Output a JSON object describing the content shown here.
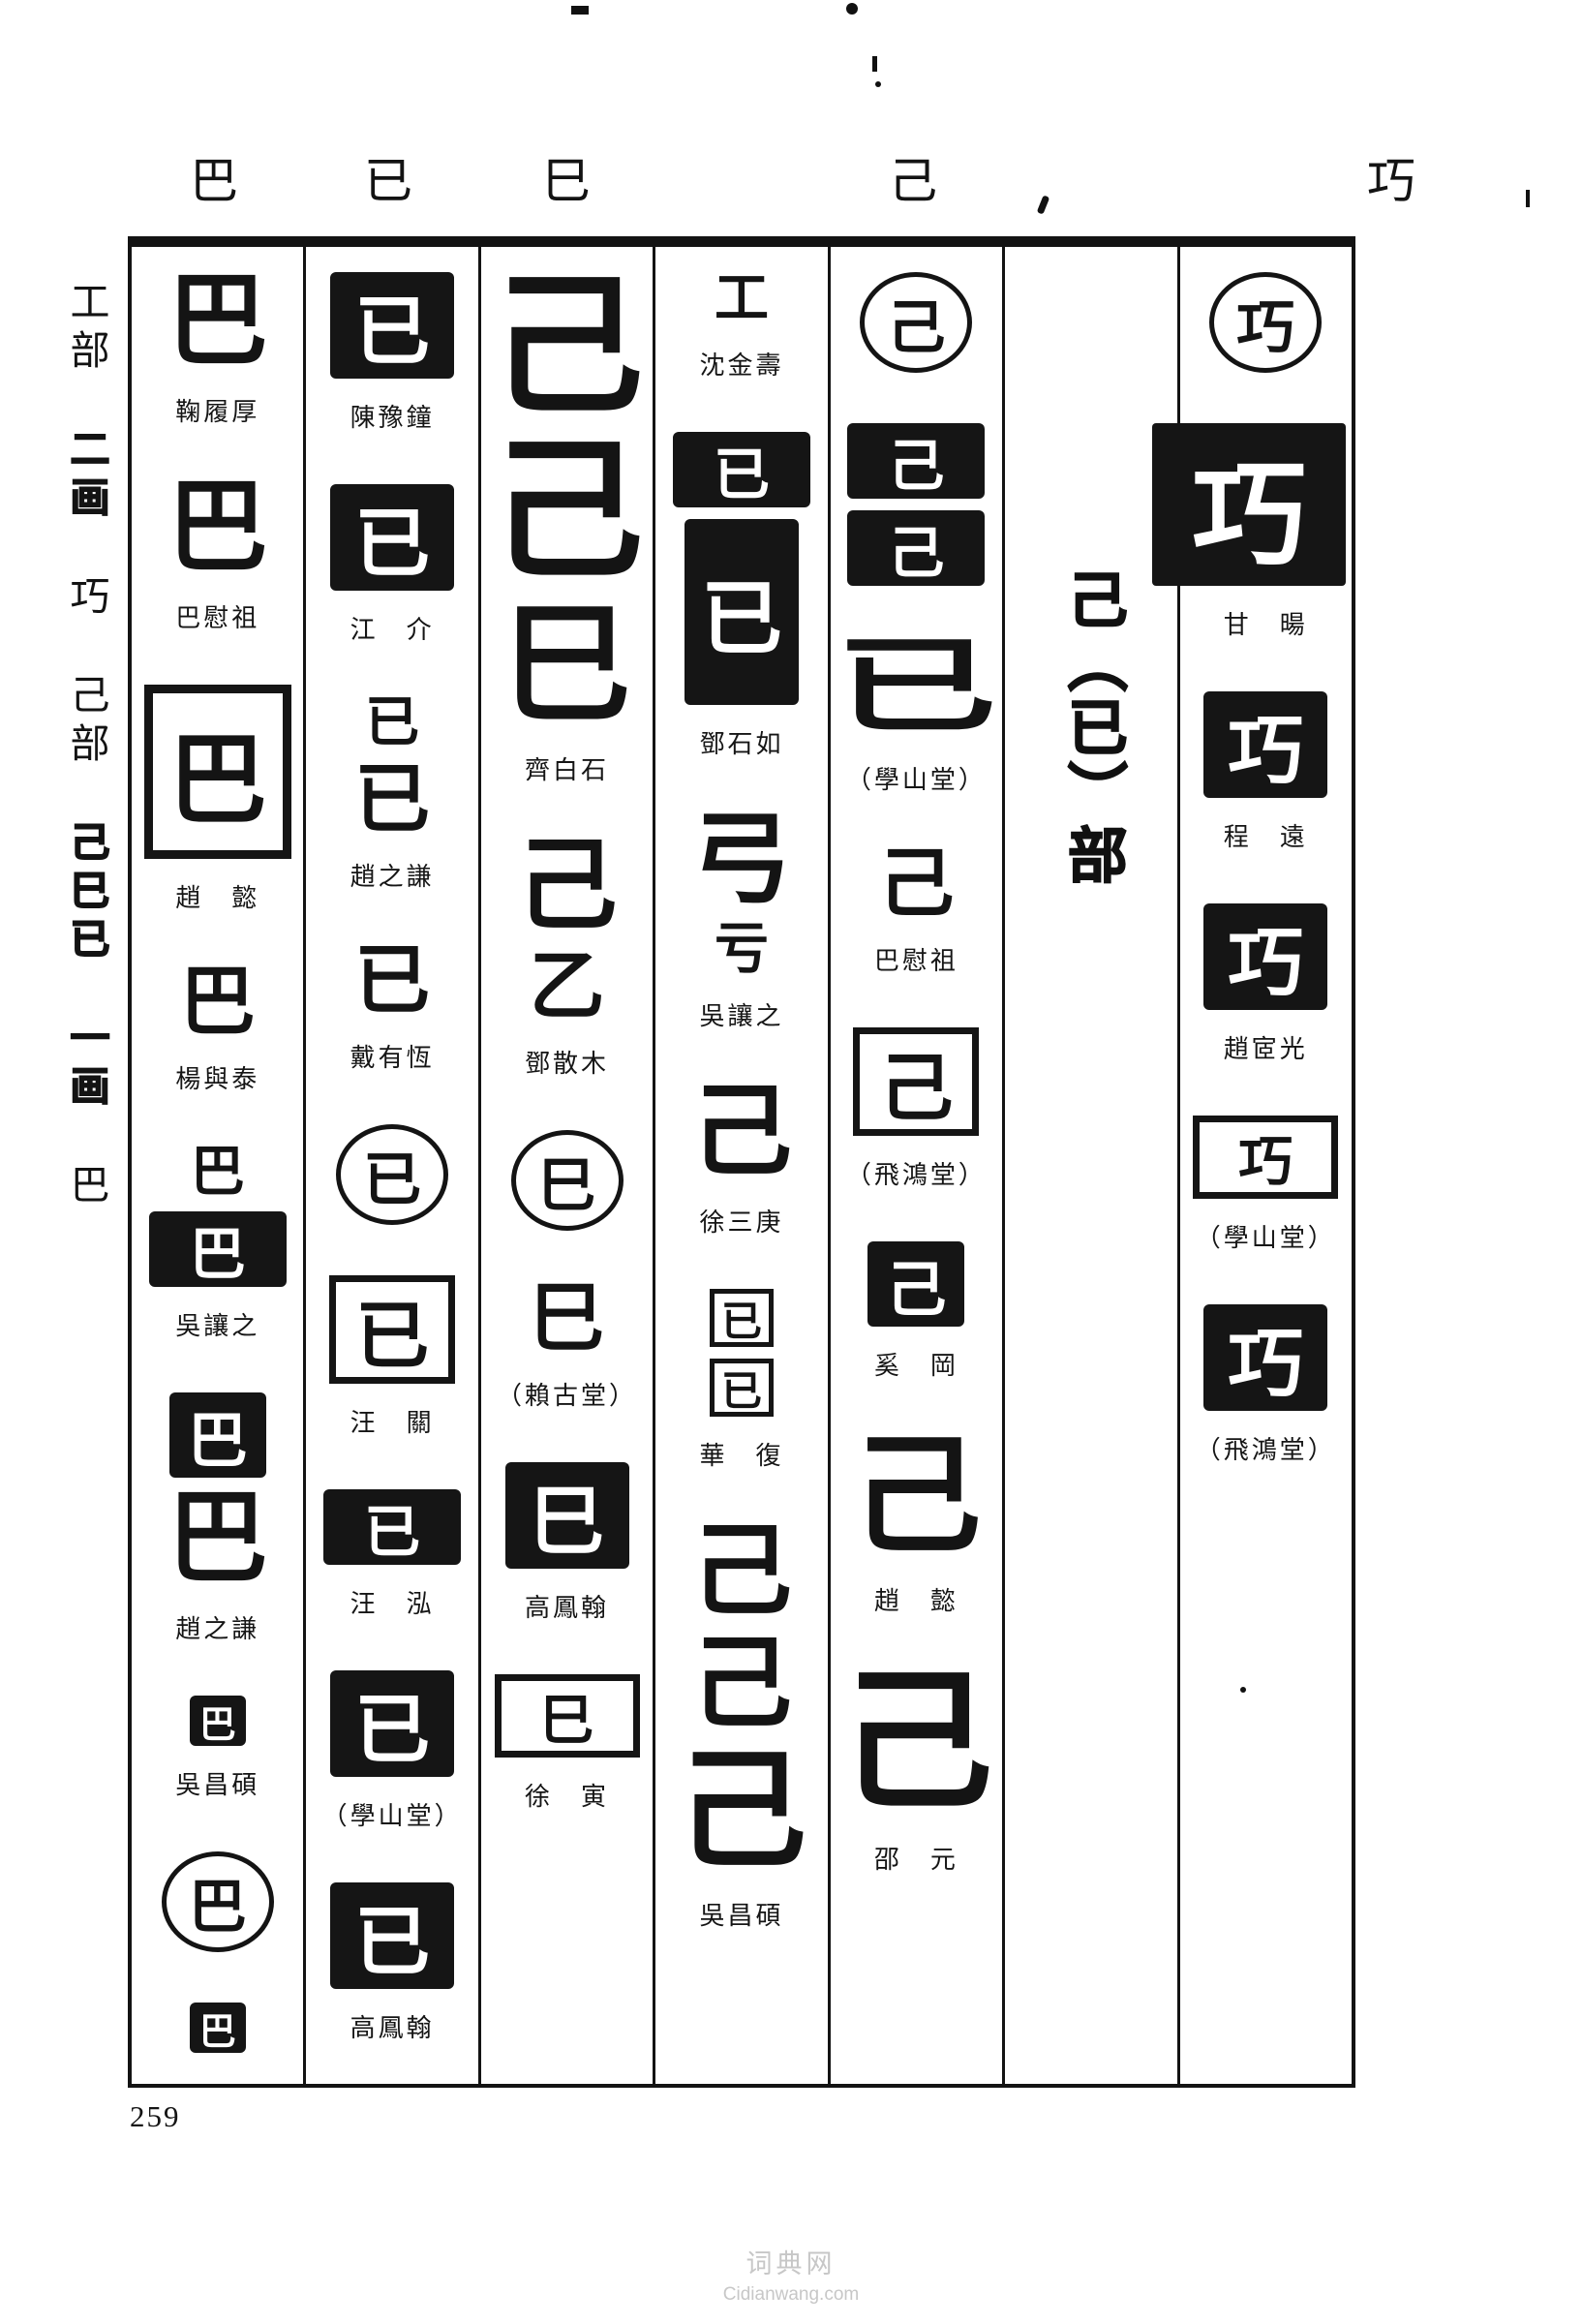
{
  "page": {
    "number": "259",
    "watermark_name": "词典网",
    "watermark_url": "Cidianwang.com",
    "ink_color": "#131313",
    "paper_color": "#ffffff",
    "watermark_color": "#c7c7c7"
  },
  "header": {
    "chars": [
      "巴",
      "已",
      "巳",
      "己",
      "巧"
    ]
  },
  "sidebar": {
    "items": [
      {
        "text": "工部",
        "bold": false
      },
      {
        "text": "二画",
        "bold": true
      },
      {
        "text": "巧",
        "bold": false
      },
      {
        "text": "己部",
        "bold": false
      },
      {
        "text": "己巳已",
        "bold": true
      },
      {
        "text": "一画",
        "bold": true
      },
      {
        "text": "巴",
        "bold": false
      }
    ]
  },
  "section_title": {
    "text": "己（已）部"
  },
  "columns": [
    {
      "head": "巴",
      "entries": [
        {
          "seals": [
            {
              "type": "brush",
              "ch": "巴",
              "size": "md"
            }
          ],
          "name": "鞠履厚"
        },
        {
          "seals": [
            {
              "type": "brush",
              "ch": "巴",
              "size": "md"
            }
          ],
          "name": "巴慰祖"
        },
        {
          "seals": [
            {
              "type": "outline",
              "ch": "巴",
              "size": "lg"
            }
          ],
          "name": "趙　懿"
        },
        {
          "seals": [
            {
              "type": "brush",
              "ch": "巴",
              "size": "sm"
            }
          ],
          "name": "楊與泰"
        },
        {
          "seals": [
            {
              "type": "brush",
              "ch": "巴",
              "size": "xs"
            },
            {
              "type": "black",
              "ch": "巴",
              "size": "bar"
            }
          ],
          "name": "吳讓之"
        },
        {
          "seals": [
            {
              "type": "black",
              "ch": "巴",
              "size": "sm"
            },
            {
              "type": "brush",
              "ch": "巴",
              "size": "md"
            }
          ],
          "name": "趙之謙"
        },
        {
          "seals": [
            {
              "type": "black",
              "ch": "巴",
              "size": "xs"
            }
          ],
          "name": "吳昌碩"
        },
        {
          "seals": [
            {
              "type": "circle",
              "ch": "巴",
              "size": "md"
            }
          ],
          "name": ""
        },
        {
          "seals": [
            {
              "type": "black",
              "ch": "巴",
              "size": "xs"
            }
          ],
          "name": ""
        }
      ]
    },
    {
      "head": "已",
      "entries": [
        {
          "seals": [
            {
              "type": "black",
              "ch": "已",
              "size": "md"
            }
          ],
          "name": "陳豫鐘"
        },
        {
          "seals": [
            {
              "type": "black",
              "ch": "已",
              "size": "md"
            }
          ],
          "name": "江　介"
        },
        {
          "seals": [
            {
              "type": "brush",
              "ch": "已",
              "size": "xs"
            },
            {
              "type": "brush",
              "ch": "已",
              "size": "sm"
            }
          ],
          "name": "趙之謙"
        },
        {
          "seals": [
            {
              "type": "brush",
              "ch": "已",
              "size": "sm"
            }
          ],
          "name": "戴有恆"
        },
        {
          "seals": [
            {
              "type": "circle",
              "ch": "已",
              "size": "md"
            }
          ],
          "name": ""
        },
        {
          "seals": [
            {
              "type": "outline",
              "ch": "已",
              "size": "md"
            }
          ],
          "name": "汪　關"
        },
        {
          "seals": [
            {
              "type": "black",
              "ch": "已",
              "size": "bar"
            }
          ],
          "name": "汪　泓"
        },
        {
          "seals": [
            {
              "type": "black",
              "ch": "已",
              "size": "md"
            }
          ],
          "name": "（學山堂）"
        },
        {
          "seals": [
            {
              "type": "black",
              "ch": "已",
              "size": "md"
            }
          ],
          "name": "高鳳翰"
        }
      ]
    },
    {
      "head": "巳",
      "entries": [
        {
          "seals": [
            {
              "type": "brush",
              "ch": "己",
              "size": "xl"
            },
            {
              "type": "brush",
              "ch": "己",
              "size": "xl"
            },
            {
              "type": "brush",
              "ch": "巳",
              "size": "lg"
            }
          ],
          "name": "齊白石"
        },
        {
          "seals": [
            {
              "type": "brush",
              "ch": "己",
              "size": "md"
            },
            {
              "type": "brush",
              "ch": "乙",
              "size": "sm"
            }
          ],
          "name": "鄧散木"
        },
        {
          "seals": [
            {
              "type": "circle",
              "ch": "巳",
              "size": "md"
            }
          ],
          "name": ""
        },
        {
          "seals": [
            {
              "type": "brush",
              "ch": "巳",
              "size": "sm"
            }
          ],
          "name": "（賴古堂）"
        },
        {
          "seals": [
            {
              "type": "black",
              "ch": "巳",
              "size": "md"
            }
          ],
          "name": "高鳳翰"
        },
        {
          "seals": [
            {
              "type": "outline",
              "ch": "巳",
              "size": "bar"
            }
          ],
          "name": "徐　寅"
        }
      ]
    },
    {
      "head": "",
      "entries": [
        {
          "seals": [
            {
              "type": "brush",
              "ch": "工",
              "size": "xs"
            }
          ],
          "name": "沈金壽"
        },
        {
          "seals": [
            {
              "type": "black",
              "ch": "已",
              "size": "bar"
            },
            {
              "type": "black",
              "ch": "已",
              "size": "tall"
            }
          ],
          "name": "鄧石如"
        },
        {
          "seals": [
            {
              "type": "brush",
              "ch": "弓",
              "size": "md"
            },
            {
              "type": "brush",
              "ch": "亏",
              "size": "xs"
            }
          ],
          "name": "吳讓之"
        },
        {
          "seals": [
            {
              "type": "brush",
              "ch": "己",
              "size": "md"
            }
          ],
          "name": "徐三庚"
        },
        {
          "seals": [
            {
              "type": "outline",
              "ch": "已",
              "size": "xs"
            },
            {
              "type": "outline",
              "ch": "已",
              "size": "xs"
            }
          ],
          "name": "華　復"
        },
        {
          "seals": [
            {
              "type": "brush",
              "ch": "己",
              "size": "md"
            },
            {
              "type": "brush",
              "ch": "己",
              "size": "md"
            },
            {
              "type": "brush",
              "ch": "己",
              "size": "lg"
            }
          ],
          "name": "吳昌碩"
        }
      ]
    },
    {
      "head": "己",
      "entries": [
        {
          "seals": [
            {
              "type": "circle",
              "ch": "己",
              "size": "md"
            }
          ],
          "name": ""
        },
        {
          "seals": [
            {
              "type": "black",
              "ch": "己",
              "size": "bar"
            },
            {
              "type": "black",
              "ch": "己",
              "size": "bar"
            }
          ],
          "name": ""
        },
        {
          "seals": [
            {
              "type": "brush",
              "ch": "已",
              "size": "wide"
            }
          ],
          "name": "（學山堂）"
        },
        {
          "seals": [
            {
              "type": "brush",
              "ch": "己",
              "size": "sm"
            }
          ],
          "name": "巴慰祖"
        },
        {
          "seals": [
            {
              "type": "outline",
              "ch": "己",
              "size": "md"
            }
          ],
          "name": "（飛鴻堂）"
        },
        {
          "seals": [
            {
              "type": "black",
              "ch": "己",
              "size": "sm"
            }
          ],
          "name": "奚　岡"
        },
        {
          "seals": [
            {
              "type": "brush",
              "ch": "己",
              "size": "lg"
            }
          ],
          "name": "趙　懿"
        },
        {
          "seals": [
            {
              "type": "brush",
              "ch": "己",
              "size": "xl"
            }
          ],
          "name": "邵　元"
        }
      ]
    },
    {
      "head": "",
      "is_section_divider": true,
      "entries": []
    },
    {
      "head": "巧",
      "entries": [
        {
          "seals": [
            {
              "type": "circle",
              "ch": "巧",
              "size": "md"
            }
          ],
          "name": ""
        },
        {
          "seals": [
            {
              "type": "black",
              "ch": "巧",
              "size": "xl"
            }
          ],
          "name": "甘　暘"
        },
        {
          "seals": [
            {
              "type": "black",
              "ch": "巧",
              "size": "md"
            }
          ],
          "name": "程　遠"
        },
        {
          "seals": [
            {
              "type": "black",
              "ch": "巧",
              "size": "md"
            }
          ],
          "name": "趙宧光"
        },
        {
          "seals": [
            {
              "type": "outline",
              "ch": "巧",
              "size": "bar"
            }
          ],
          "name": "（學山堂）"
        },
        {
          "seals": [
            {
              "type": "black",
              "ch": "巧",
              "size": "md"
            }
          ],
          "name": "（飛鴻堂）"
        }
      ]
    }
  ]
}
